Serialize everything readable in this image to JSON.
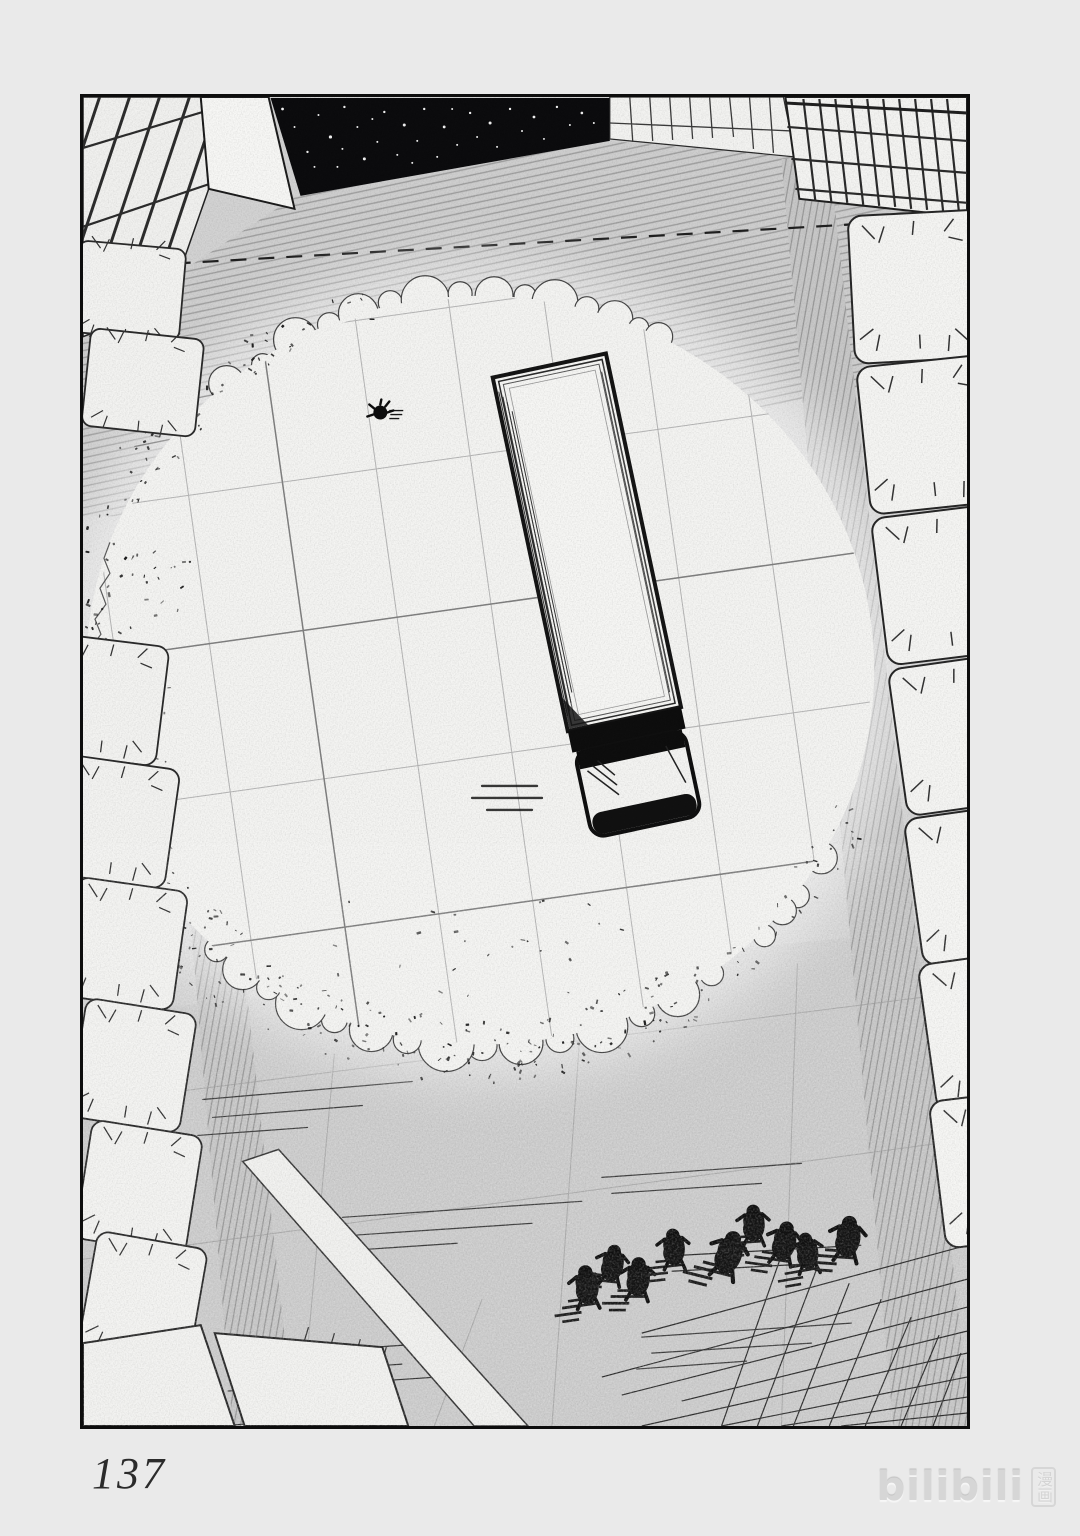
{
  "page": {
    "number": "137"
  },
  "watermark": {
    "logo": "bilibili",
    "label": "漫画"
  },
  "colors": {
    "paper": "#eaeaea",
    "ink": "#141414",
    "street_tone": "#d3d3d3",
    "crater_white": "#f4f4f2",
    "night_sky": "#0b0b0d",
    "watermark_gray": "#d6d6d6"
  },
  "scene": {
    "crater": {
      "cx": 398,
      "cy": 574,
      "rx": 395,
      "ry": 375
    },
    "seed": 11,
    "stars": [
      [
        200,
        12,
        1.4
      ],
      [
        212,
        30,
        1
      ],
      [
        225,
        55,
        1.2
      ],
      [
        236,
        18,
        1
      ],
      [
        248,
        40,
        1.6
      ],
      [
        255,
        70,
        1
      ],
      [
        262,
        10,
        1.2
      ],
      [
        275,
        30,
        1
      ],
      [
        282,
        62,
        1.5
      ],
      [
        295,
        45,
        1
      ],
      [
        302,
        15,
        1.2
      ],
      [
        315,
        58,
        1
      ],
      [
        322,
        28,
        1.5
      ],
      [
        335,
        44,
        1
      ],
      [
        342,
        12,
        1.2
      ],
      [
        355,
        60,
        1
      ],
      [
        362,
        30,
        1.4
      ],
      [
        375,
        48,
        1
      ],
      [
        388,
        16,
        1.2
      ],
      [
        395,
        40,
        1
      ],
      [
        408,
        26,
        1.5
      ],
      [
        415,
        50,
        1
      ],
      [
        428,
        12,
        1.2
      ],
      [
        440,
        34,
        1
      ],
      [
        452,
        20,
        1.4
      ],
      [
        462,
        42,
        1
      ],
      [
        475,
        10,
        1.2
      ],
      [
        488,
        28,
        1
      ],
      [
        500,
        16,
        1.3
      ],
      [
        512,
        26,
        1
      ],
      [
        232,
        70,
        1
      ],
      [
        260,
        52,
        1
      ],
      [
        290,
        22,
        1
      ],
      [
        330,
        66,
        1
      ],
      [
        370,
        12,
        1
      ]
    ],
    "figures": [
      [
        505,
        1194,
        1.7,
        -8
      ],
      [
        530,
        1172,
        1.6,
        6
      ],
      [
        556,
        1186,
        1.7,
        0
      ],
      [
        592,
        1156,
        1.6,
        -6
      ],
      [
        646,
        1162,
        1.9,
        14
      ],
      [
        672,
        1132,
        1.6,
        -4
      ],
      [
        702,
        1150,
        1.7,
        8
      ],
      [
        726,
        1160,
        1.6,
        -10
      ],
      [
        766,
        1146,
        1.8,
        4
      ]
    ],
    "lone_figure": [
      298,
      316
    ],
    "debris_bands": [
      {
        "a0": 55,
        "a1": 125,
        "t0": 0.93,
        "t1": 1.1,
        "n": 150
      },
      {
        "a0": 125,
        "a1": 185,
        "t0": 0.9,
        "t1": 1.12,
        "n": 130
      },
      {
        "a0": 185,
        "a1": 225,
        "t0": 0.95,
        "t1": 1.1,
        "n": 55
      },
      {
        "a0": 225,
        "a1": 255,
        "t0": 0.97,
        "t1": 1.07,
        "n": 30
      },
      {
        "a0": 60,
        "a1": 120,
        "t0": 0.62,
        "t1": 0.9,
        "n": 25
      },
      {
        "a0": 150,
        "a1": 205,
        "t0": 0.78,
        "t1": 0.95,
        "n": 40
      },
      {
        "a0": 20,
        "a1": 55,
        "t0": 0.96,
        "t1": 1.06,
        "n": 30
      }
    ]
  }
}
